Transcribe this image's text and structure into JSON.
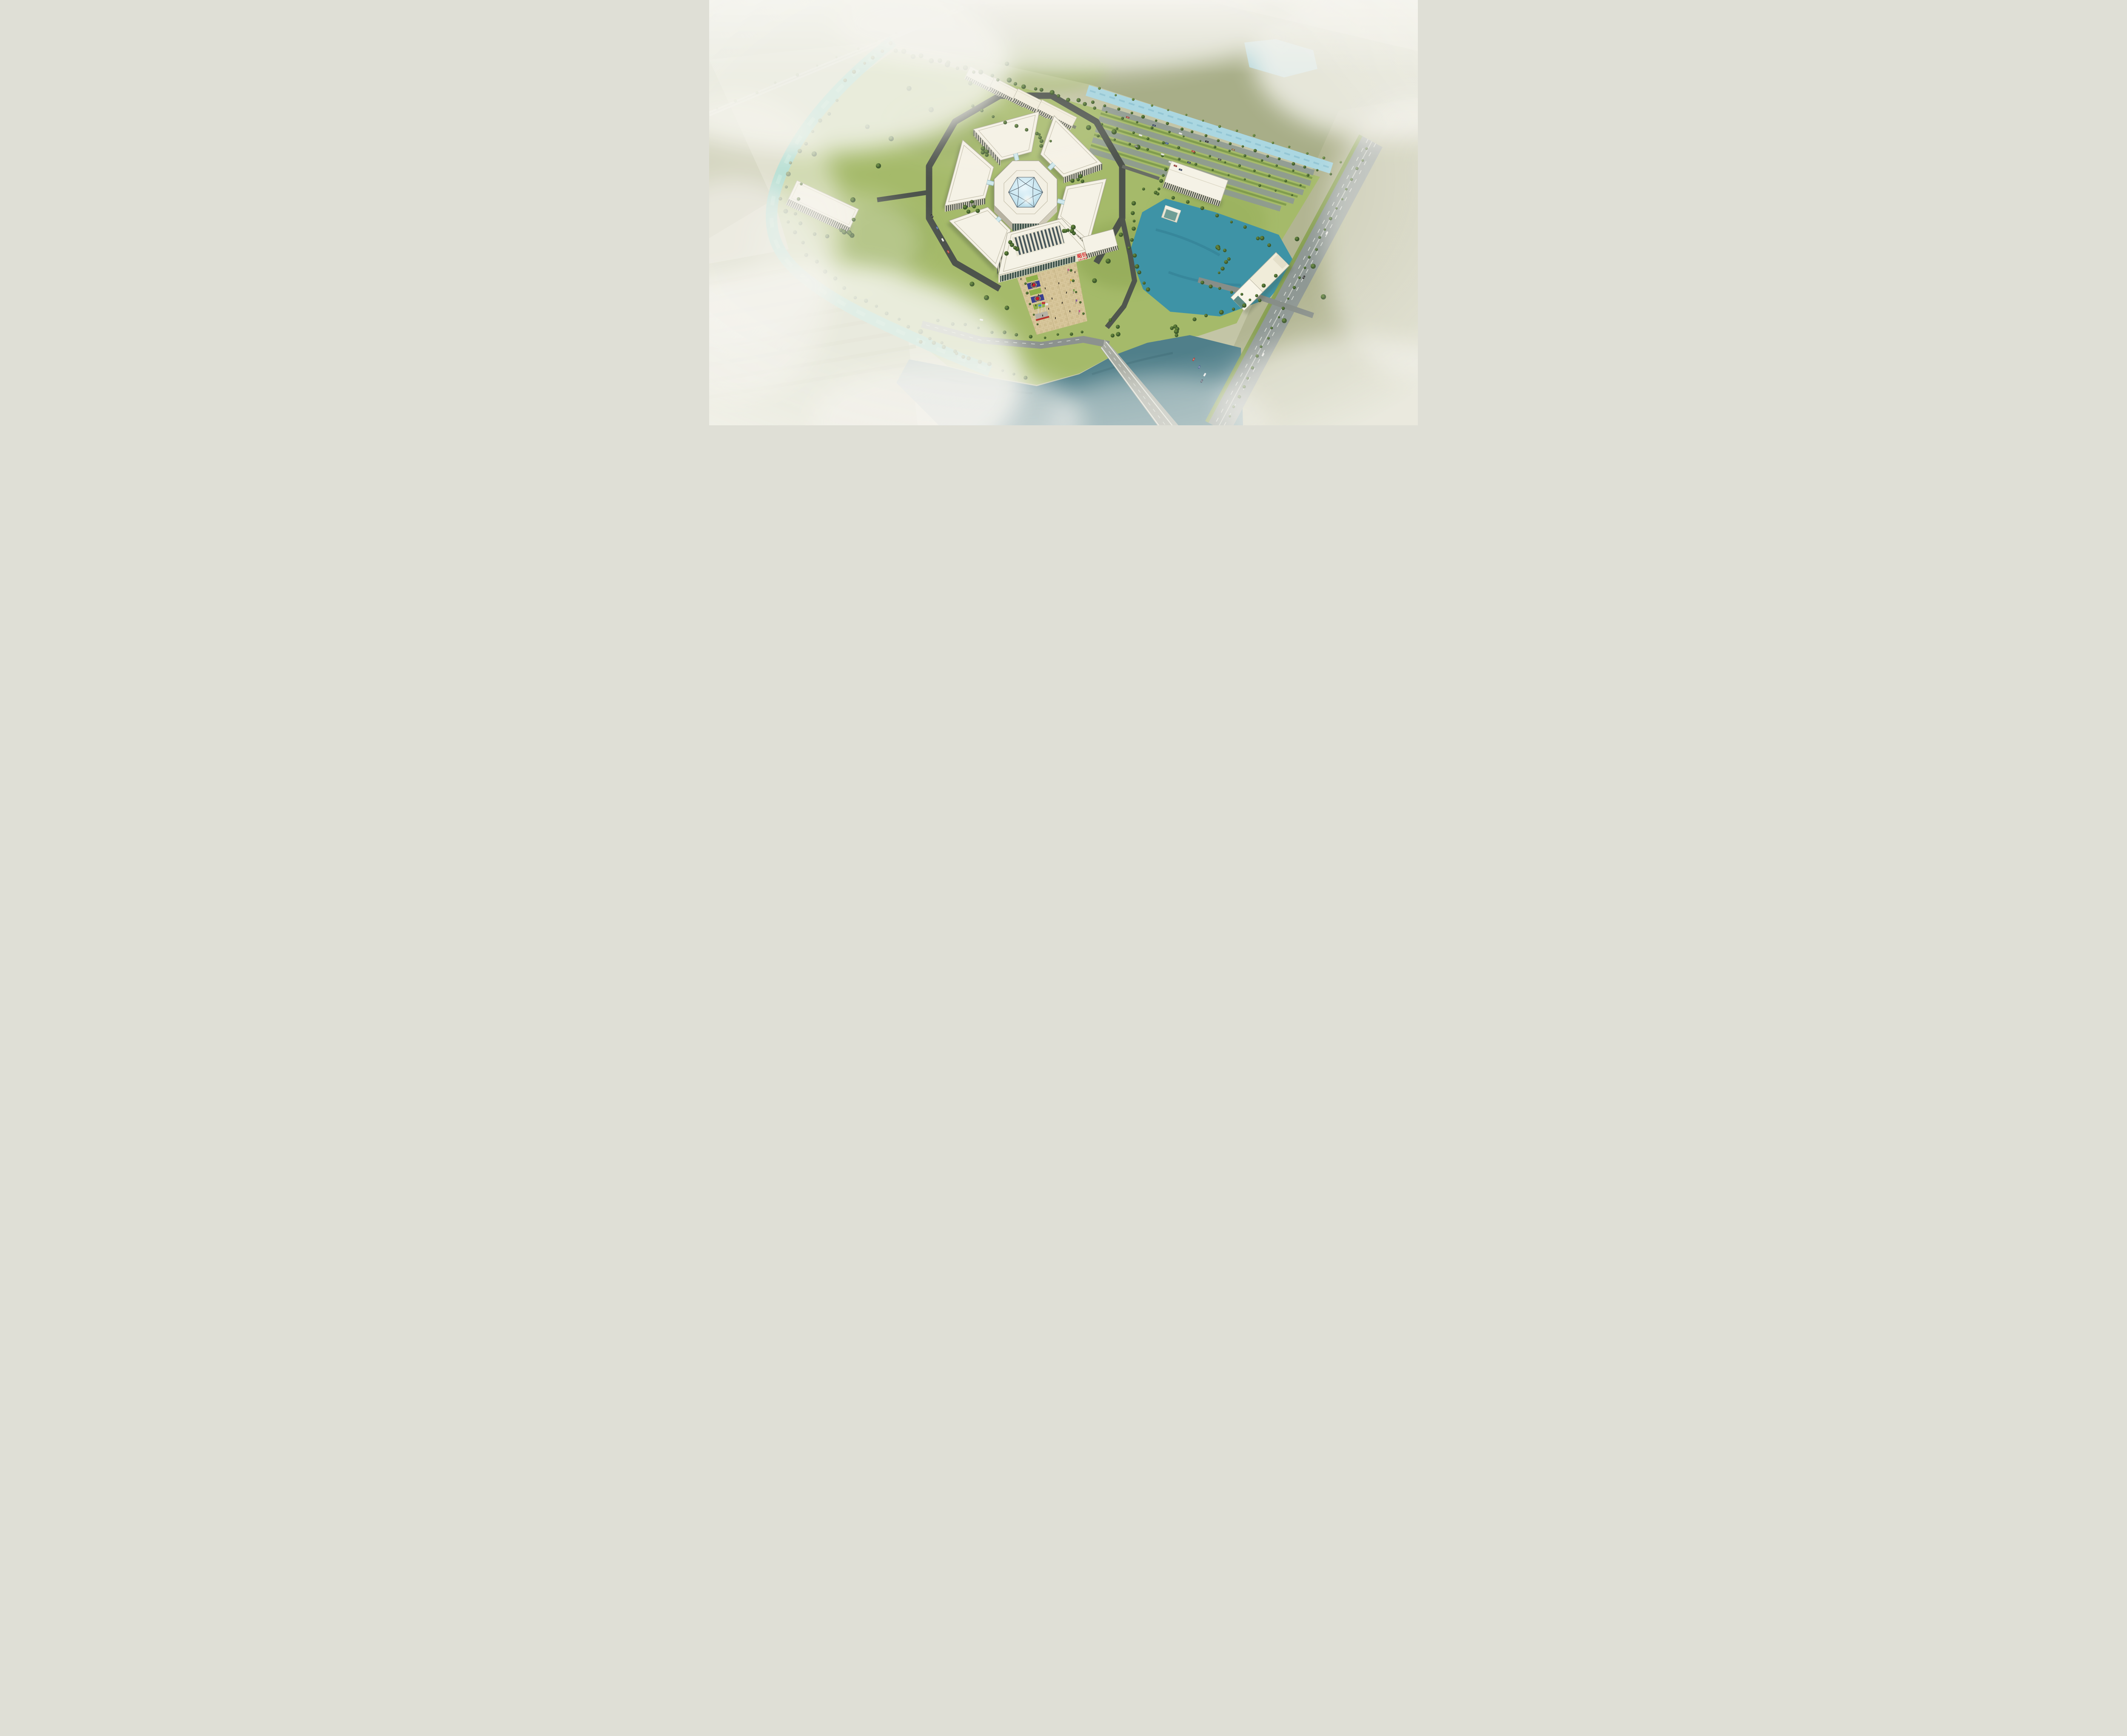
{
  "meta": {
    "domain": "architectural-rendering",
    "view": "aerial-birds-eye",
    "subject": "JOINN Laboratories research campus master-plan rendering with central glass-domed hub and radial lab wings"
  },
  "signage": {
    "building_sign_cjk": "昭衍",
    "building_sign_latin": "JOINN"
  },
  "palette": {
    "fog": "#f3f2ec",
    "field": "#b7ba9a",
    "field_olive": "#9aa37c",
    "lawn": "#a5ba6a",
    "lawn_dark": "#85a04f",
    "tree": "#3e5a2c",
    "tree_light": "#5f7f3a",
    "canal": "#6cc7b7",
    "river": "#507f8a",
    "lake": "#3e93a6",
    "canal_light": "#abd7e1",
    "road_dark": "#4d534c",
    "road_mid": "#8f9894",
    "road_light": "#aeb1a8",
    "paving": "#d9c89d",
    "roof": "#f5f2e6",
    "wall": "#d7d2bf",
    "wall_dark": "#b7b2a0",
    "window": "#39423b",
    "glass_band": "#3f544c",
    "dome_glass": "#bfe2ef",
    "dome_frame": "#4e5a64",
    "sign_red": "#e01b22",
    "emblem_blue": "#3a3f8f",
    "emblem_red": "#cc2222",
    "emblem_yellow": "#e8c32a",
    "flag_red": "#c43b3b",
    "flag_blue": "#4f86c8",
    "flag_white": "#e8e8e8",
    "bridge_glass": "#cfe8ec"
  },
  "campus": {
    "central_hub": {
      "name": "central-hub-atrium",
      "roof": "octagonal",
      "skylight": "hexagonal-triangulated-glass-dome",
      "sun_glint": true
    },
    "lab_wings": [
      {
        "name": "north-wing"
      },
      {
        "name": "northeast-wing"
      },
      {
        "name": "southeast-wing"
      },
      {
        "name": "southwest-wing"
      },
      {
        "name": "northwest-wing"
      }
    ],
    "admin_building": {
      "name": "front-administration-building",
      "features": [
        "rooftop-skylight-rows",
        "colonnade-glass-facade",
        "corporate-sign"
      ],
      "sign_cjk": "昭衍",
      "sign_latin": "JOINN"
    },
    "connectors": {
      "glass_link_bridges": 5
    },
    "auxiliary_buildings": [
      {
        "name": "dormitory-block-1"
      },
      {
        "name": "dormitory-block-2"
      },
      {
        "name": "dormitory-block-3"
      },
      {
        "name": "dormitory-block-4"
      },
      {
        "name": "west-utility-building"
      },
      {
        "name": "east-office-building",
        "annex": "glass-atrium-annex"
      },
      {
        "name": "gatehouse"
      }
    ]
  },
  "landscape": {
    "water_bodies": [
      {
        "name": "west-canal",
        "tone": "turquoise"
      },
      {
        "name": "south-river",
        "tone": "slate-teal"
      },
      {
        "name": "east-lake",
        "tone": "blue-teal"
      },
      {
        "name": "northeast-canal",
        "tone": "pale-blue"
      },
      {
        "name": "corner-pond",
        "tone": "pale-blue"
      }
    ],
    "plaza": {
      "name": "entrance-plaza",
      "flagpoles": 3,
      "flags": [
        {
          "position": "left",
          "color_key": "flag_blue"
        },
        {
          "position": "center",
          "color_key": "flag_red"
        },
        {
          "position": "right",
          "color_key": "flag_white"
        }
      ],
      "flower_emblem_beds": 2,
      "banner_poles": 5,
      "pedestrians": 14
    },
    "roads": [
      {
        "name": "highway",
        "lanes": "dashed-markings"
      },
      {
        "name": "site-loop-road"
      },
      {
        "name": "south-access-road"
      },
      {
        "name": "gate-road"
      }
    ],
    "bridge": {
      "name": "river-bridge"
    },
    "parking": {
      "rows": 5,
      "location": "northeast",
      "cars_scattered": true
    }
  },
  "atmosphere": {
    "fog": "heavy white mist over the outer farmland, all four edges",
    "lighting": "overcast daylight with sun glint on the dome"
  }
}
